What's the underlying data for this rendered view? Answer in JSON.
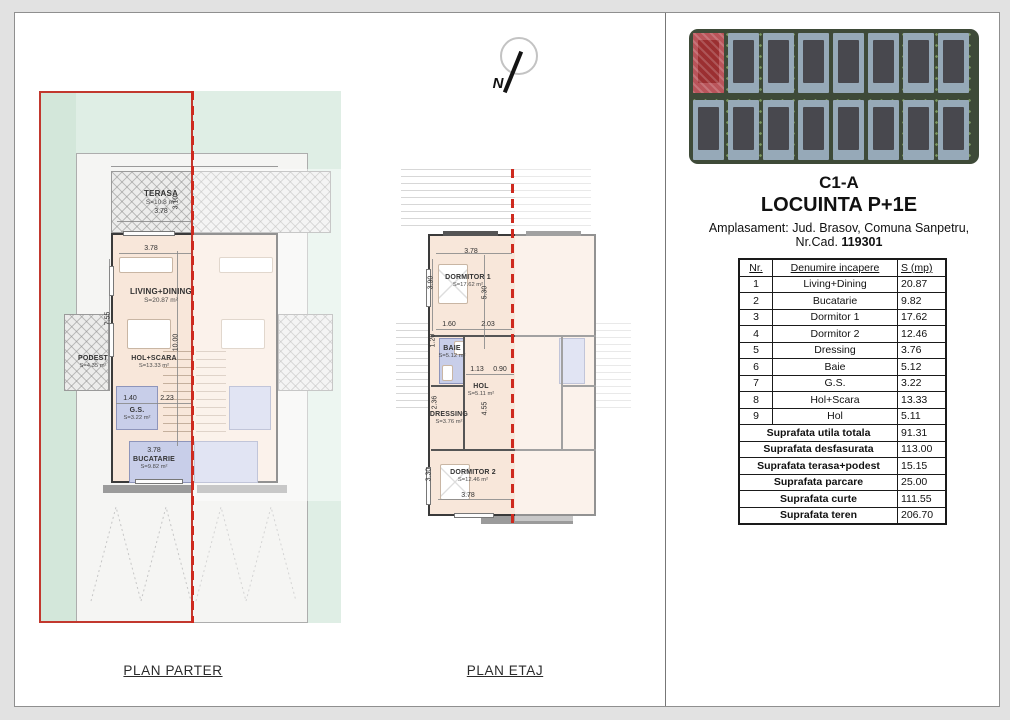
{
  "north": {
    "label": "N"
  },
  "plan_labels": {
    "parter": "PLAN PARTER",
    "etaj": "PLAN ETAJ"
  },
  "title_block": {
    "code": "C1-A",
    "name": "LOCUINTA P+1E",
    "address": "Amplasament: Jud. Brasov, Comuna Sanpetru,",
    "cad_label": "Nr.Cad.",
    "cad_number": "119301"
  },
  "area_table": {
    "headers": [
      "Nr.",
      "Denumire incapere",
      "S (mp)"
    ],
    "rows": [
      [
        "1",
        "Living+Dining",
        "20.87"
      ],
      [
        "2",
        "Bucatarie",
        "9.82"
      ],
      [
        "3",
        "Dormitor 1",
        "17.62"
      ],
      [
        "4",
        "Dormitor 2",
        "12.46"
      ],
      [
        "5",
        "Dressing",
        "3.76"
      ],
      [
        "6",
        "Baie",
        "5.12"
      ],
      [
        "7",
        "G.S.",
        "3.22"
      ],
      [
        "8",
        "Hol+Scara",
        "13.33"
      ],
      [
        "9",
        "Hol",
        "5.11"
      ]
    ],
    "summary": [
      [
        "Suprafata utila totala",
        "91.31"
      ],
      [
        "Suprafata desfasurata",
        "113.00"
      ],
      [
        "Suprafata terasa+podest",
        "15.15"
      ],
      [
        "Suprafata parcare",
        "25.00"
      ],
      [
        "Suprafata curte",
        "111.55"
      ],
      [
        "Suprafata teren",
        "206.70"
      ]
    ]
  },
  "parter": {
    "rooms": {
      "terasa": {
        "name": "TERASA",
        "area": "S=10.8 m²"
      },
      "living": {
        "name": "LIVING+DINING",
        "area": "S=20.87 m²"
      },
      "podest": {
        "name": "PODEST",
        "area": "S=4.35 m²"
      },
      "hol_scara": {
        "name": "HOL+SCARA",
        "area": "S=13.33 m²"
      },
      "gs": {
        "name": "G.S.",
        "area": "S=3.22 m²"
      },
      "bucatarie": {
        "name": "BUCATARIE",
        "area": "S=9.82 m²"
      }
    },
    "dims": {
      "terasa_w": "3.78",
      "terasa_h": "3.10",
      "living_w": "3.78",
      "living_h": "7.55",
      "total_h": "10.00",
      "gs_w": "1.40",
      "hol_w": "2.23",
      "buc_w": "3.78"
    }
  },
  "etaj": {
    "rooms": {
      "dormitor1": {
        "name": "DORMITOR 1",
        "area": "S=17.62 m²"
      },
      "baie": {
        "name": "BAIE",
        "area": "S=5.12 m²"
      },
      "hol": {
        "name": "HOL",
        "area": "S=5.11 m²"
      },
      "dressing": {
        "name": "DRESSING",
        "area": "S=3.76 m²"
      },
      "dormitor2": {
        "name": "DORMITOR 2",
        "area": "S=12.46 m²"
      }
    },
    "dims": {
      "d1_w": "3.78",
      "d1_h": "3.90",
      "d1_h2": "5.30",
      "baie_w": "1.60",
      "baie_h": "1.20",
      "hol_top": "2.03",
      "hol_w1": "1.13",
      "hol_w2": "0.90",
      "hol_h": "4.55",
      "dressing_h": "2.36",
      "d2_h": "3.30",
      "d2_w": "3.78"
    }
  }
}
